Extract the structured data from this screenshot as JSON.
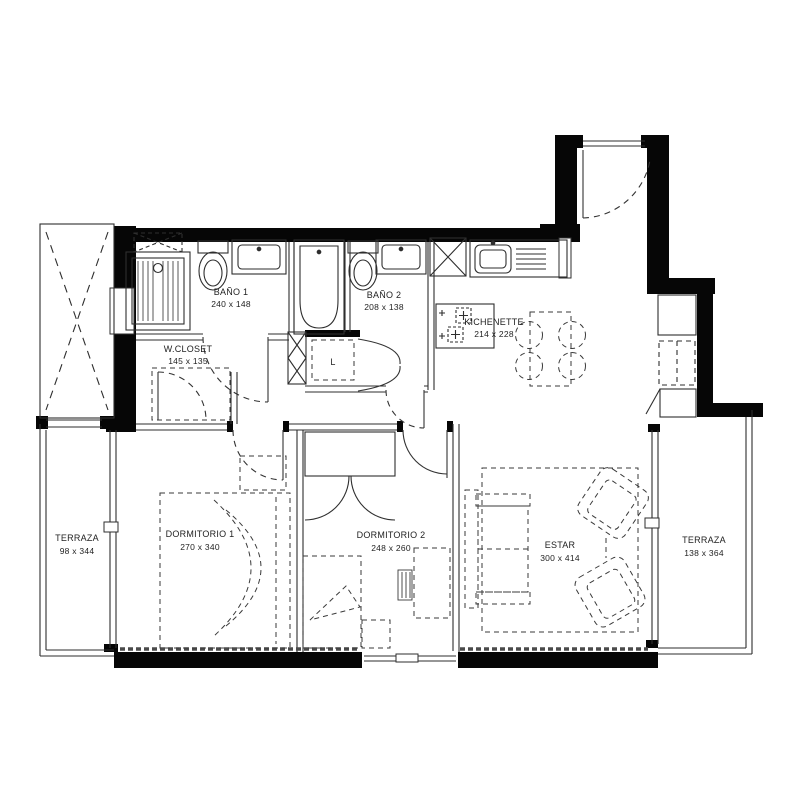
{
  "plan": {
    "type": "apartment-floor-plan",
    "rooms": {
      "bano1": {
        "name": "BAÑO 1",
        "dims": "240 x 148"
      },
      "bano2": {
        "name": "BAÑO 2",
        "dims": "208 x 138"
      },
      "wcloset": {
        "name": "W.CLOSET",
        "dims": "145 x 135"
      },
      "kichenette": {
        "name": "KICHENETTE",
        "dims": "214 x 228"
      },
      "dormitorio1": {
        "name": "DORMITORIO 1",
        "dims": "270 x 340"
      },
      "dormitorio2": {
        "name": "DORMITORIO 2",
        "dims": "248 x 260"
      },
      "estar": {
        "name": "ESTAR",
        "dims": "300 x 414"
      },
      "terraza_izq": {
        "name": "TERRAZA",
        "dims": "98 x 344"
      },
      "terraza_der": {
        "name": "TERRAZA",
        "dims": "138 x 364"
      },
      "laundry": {
        "name": "L"
      }
    },
    "colors": {
      "wall": "#060606",
      "line": "#2e2e2e",
      "furniture": "#3a3a3a",
      "text": "#1f1f1f",
      "background": "#ffffff"
    }
  }
}
